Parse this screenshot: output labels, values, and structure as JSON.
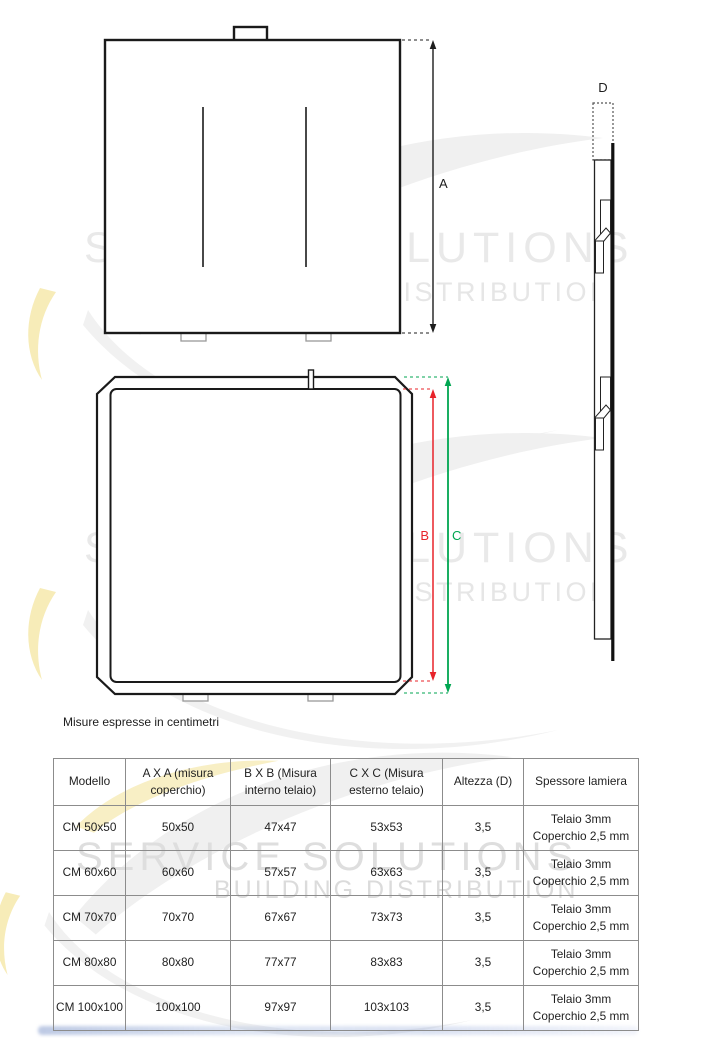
{
  "note": "Misure espresse in centimetri",
  "watermark": {
    "line1": "SERVICE SOLUTIONS",
    "line2": "BUILDING DISTRIBUTION"
  },
  "labels": {
    "a": "A",
    "b": "B",
    "c": "C",
    "d": "D"
  },
  "colors": {
    "dim_b": "#e8232a",
    "dim_c": "#00a651",
    "dim_a": "#1d1d1d",
    "line": "#1a1a1a"
  },
  "table": {
    "headers": [
      "Modello",
      "A X A (misura coperchio)",
      "B X B (Misura interno telaio)",
      "C X C (Misura esterno telaio)",
      "Altezza (D)",
      "Spessore lamiera"
    ],
    "rows": [
      {
        "cells": [
          "CM 50x50",
          "50x50",
          "47x47",
          "53x53",
          "3,5",
          "Telaio 3mm\nCoperchio 2,5 mm"
        ]
      },
      {
        "cells": [
          "CM 60x60",
          "60x60",
          "57x57",
          "63x63",
          "3,5",
          "Telaio 3mm\nCoperchio 2,5 mm"
        ]
      },
      {
        "cells": [
          "CM 70x70",
          "70x70",
          "67x67",
          "73x73",
          "3,5",
          "Telaio 3mm\nCoperchio 2,5 mm"
        ]
      },
      {
        "cells": [
          "CM 80x80",
          "80x80",
          "77x77",
          "83x83",
          "3,5",
          "Telaio 3mm\nCoperchio 2,5 mm"
        ]
      },
      {
        "cells": [
          "CM 100x100",
          "100x100",
          "97x97",
          "103x103",
          "3,5",
          "Telaio 3mm\nCoperchio 2,5 mm"
        ]
      }
    ]
  }
}
